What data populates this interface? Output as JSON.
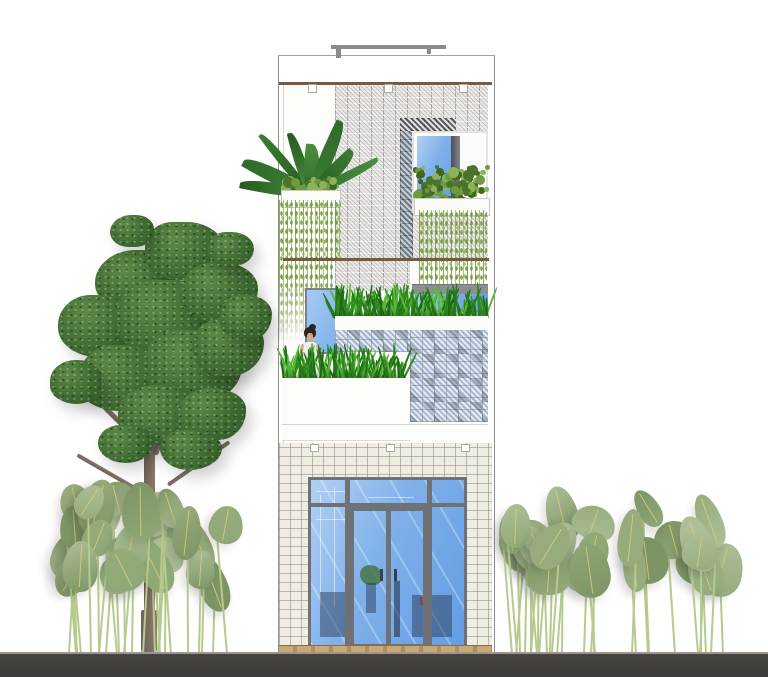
{
  "scene": {
    "title": "Tube-house front elevation with vertical gardens",
    "type": "architectural-elevation-rendering",
    "objects": [
      {
        "name": "narrow-house-facade",
        "note": "three-storey white facade with perforated breeze-block screen"
      },
      {
        "name": "breeze-block-screen",
        "note": "decorative concrete blocks, some glazed blue, some dark"
      },
      {
        "name": "upper-window",
        "note": "blue glazing with dark mullion and planter hedge"
      },
      {
        "name": "hanging-vine-curtains",
        "note": "two green vine curtains from planter boxes"
      },
      {
        "name": "terrace-grass-planters",
        "note": "two rows of grass planting"
      },
      {
        "name": "blue-terrace-door",
        "note": "light blue glazed door on mid terrace"
      },
      {
        "name": "woman-figure",
        "note": "woman with dark hair standing behind terrace planting"
      },
      {
        "name": "stone-clad-ground-floor",
        "note": "speckled terrazzo cladding around glass storefront"
      },
      {
        "name": "glass-storefront-with-double-doors",
        "note": "grey framed, interior stair and furniture visible"
      },
      {
        "name": "roof-rail",
        "note": "thin railing element above parapet"
      },
      {
        "name": "large-street-tree",
        "note": "dark green canopy, grey-brown trunk, left of house"
      },
      {
        "name": "banana-leaf-shrubs-left",
        "note": "pale green oval leaves on thin stems"
      },
      {
        "name": "banana-leaf-shrubs-right",
        "note": "pale green oval leaves on thin stems"
      },
      {
        "name": "ground-strip",
        "note": "dark grey ground band across full width"
      },
      {
        "name": "timber-threshold",
        "note": "tan wood strip at storefront base"
      }
    ],
    "palette": {
      "glass": "#7fb0ea",
      "frame": "#6e7277",
      "stone": "#efece2",
      "slab": "#7a5a3e",
      "ground": "#474340",
      "ground_light": "#9a958e",
      "trunk": "#6e6057",
      "grass_dark": "#267a18",
      "grass_mid": "#2f8c1e",
      "grass_light": "#57b83a",
      "hedge_dark": "#4a7429",
      "hedge_mid": "#6f9a42",
      "hedge_light": "#8db258",
      "canopy_dark": "#2f5424",
      "canopy_mid": "#3f6b31",
      "canopy_light": "#5d8a47",
      "shrub_leaf_1": "#7d9464",
      "shrub_leaf_2": "#97ab7c",
      "shrub_leaf_3": "#aebf97",
      "shrub_leaf_4": "#8ea876",
      "shrub_stem": "#b7ca8e",
      "wood_threshold": "#c9a876"
    }
  }
}
